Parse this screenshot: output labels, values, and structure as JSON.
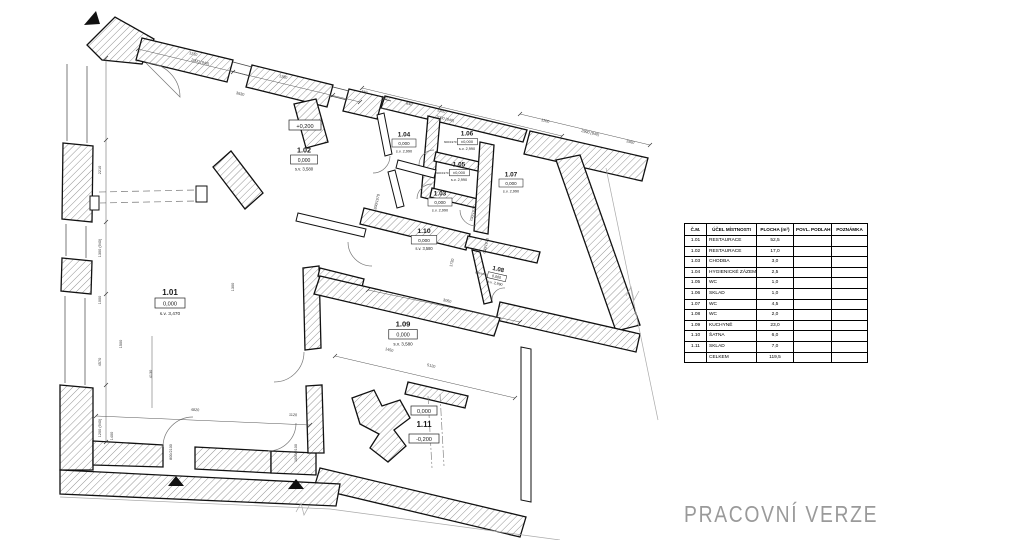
{
  "watermark": "PRACOVNÍ VERZE",
  "rooms": [
    {
      "num": "1.01",
      "elev": "0,000",
      "sv": "s.v. 3,470"
    },
    {
      "num": "1.02",
      "elev": "0,000",
      "sv": "s.v. 3,580"
    },
    {
      "num": "1.03",
      "elev": "0,000",
      "sv": "s.v. 2,990"
    },
    {
      "num": "1.04",
      "elev": "0,000",
      "sv": "s.v. 2,990"
    },
    {
      "num": "1.05",
      "elev": "±0,000",
      "sv": "s.v. 2,990",
      "dim": "600/1970"
    },
    {
      "num": "1.06",
      "elev": "±0,000",
      "sv": "s.v. 2,990",
      "dim": "600/1970"
    },
    {
      "num": "1.07",
      "elev": "0,000",
      "sv": "s.v. 2,990"
    },
    {
      "num": "1.08",
      "elev": "0,000",
      "sv": "s.v. 2,990",
      "dim": "600/1970"
    },
    {
      "num": "1.09",
      "elev": "0,000",
      "sv": "s.v. 3,580"
    },
    {
      "num": "1.10",
      "elev": "0,000",
      "sv": "s.v. 3,580"
    },
    {
      "num": "1.11",
      "elev": "0,000",
      "sv": ""
    }
  ],
  "annotations": {
    "plus200": "+0,200",
    "minus200": "-0,200"
  },
  "dims": [
    "1210",
    "2000 (940)",
    "1280",
    "3630",
    "600",
    "640",
    "1220",
    "2000 (940)",
    "740",
    "1200",
    "2990 (940)",
    "1560",
    "2210",
    "1300 (940)",
    "1000",
    "4570",
    "1200 (940)",
    "4820",
    "1120",
    "1400",
    "4130",
    "1500",
    "3050",
    "1450",
    "5120",
    "1730",
    "800/2100",
    "1000/2100",
    "800/1970",
    "700/1970",
    "600/1970",
    "1300"
  ],
  "table": {
    "headers": [
      "Č.M.",
      "ÚČEL MÍSTNOSTI",
      "PLOCHA (m²)",
      "POVL. PODLAH",
      "POZNÁMKA"
    ],
    "rows": [
      {
        "cm": "1.01",
        "ucel": "RESTAURACE",
        "plocha": "52,5",
        "povrch": "",
        "pozn": ""
      },
      {
        "cm": "1.02",
        "ucel": "RESTAURACE",
        "plocha": "17,0",
        "povrch": "",
        "pozn": ""
      },
      {
        "cm": "1.03",
        "ucel": "CHODBA",
        "plocha": "3,0",
        "povrch": "",
        "pozn": ""
      },
      {
        "cm": "1.04",
        "ucel": "HYGIENICKÉ ZÁZEMÍ",
        "plocha": "2,5",
        "povrch": "",
        "pozn": ""
      },
      {
        "cm": "1.05",
        "ucel": "WC",
        "plocha": "1,0",
        "povrch": "",
        "pozn": ""
      },
      {
        "cm": "1.06",
        "ucel": "SKLAD",
        "plocha": "1,0",
        "povrch": "",
        "pozn": ""
      },
      {
        "cm": "1.07",
        "ucel": "WC",
        "plocha": "4,5",
        "povrch": "",
        "pozn": ""
      },
      {
        "cm": "1.08",
        "ucel": "WC",
        "plocha": "2,0",
        "povrch": "",
        "pozn": ""
      },
      {
        "cm": "1.09",
        "ucel": "KUCHYNĚ",
        "plocha": "23,0",
        "povrch": "",
        "pozn": ""
      },
      {
        "cm": "1.10",
        "ucel": "ŠATNA",
        "plocha": "6,0",
        "povrch": "",
        "pozn": ""
      },
      {
        "cm": "1.11",
        "ucel": "SKLAD",
        "plocha": "7,0",
        "povrch": "",
        "pozn": ""
      },
      {
        "cm": "",
        "ucel": "CELKEM",
        "plocha": "119,5",
        "povrch": "",
        "pozn": ""
      }
    ]
  }
}
